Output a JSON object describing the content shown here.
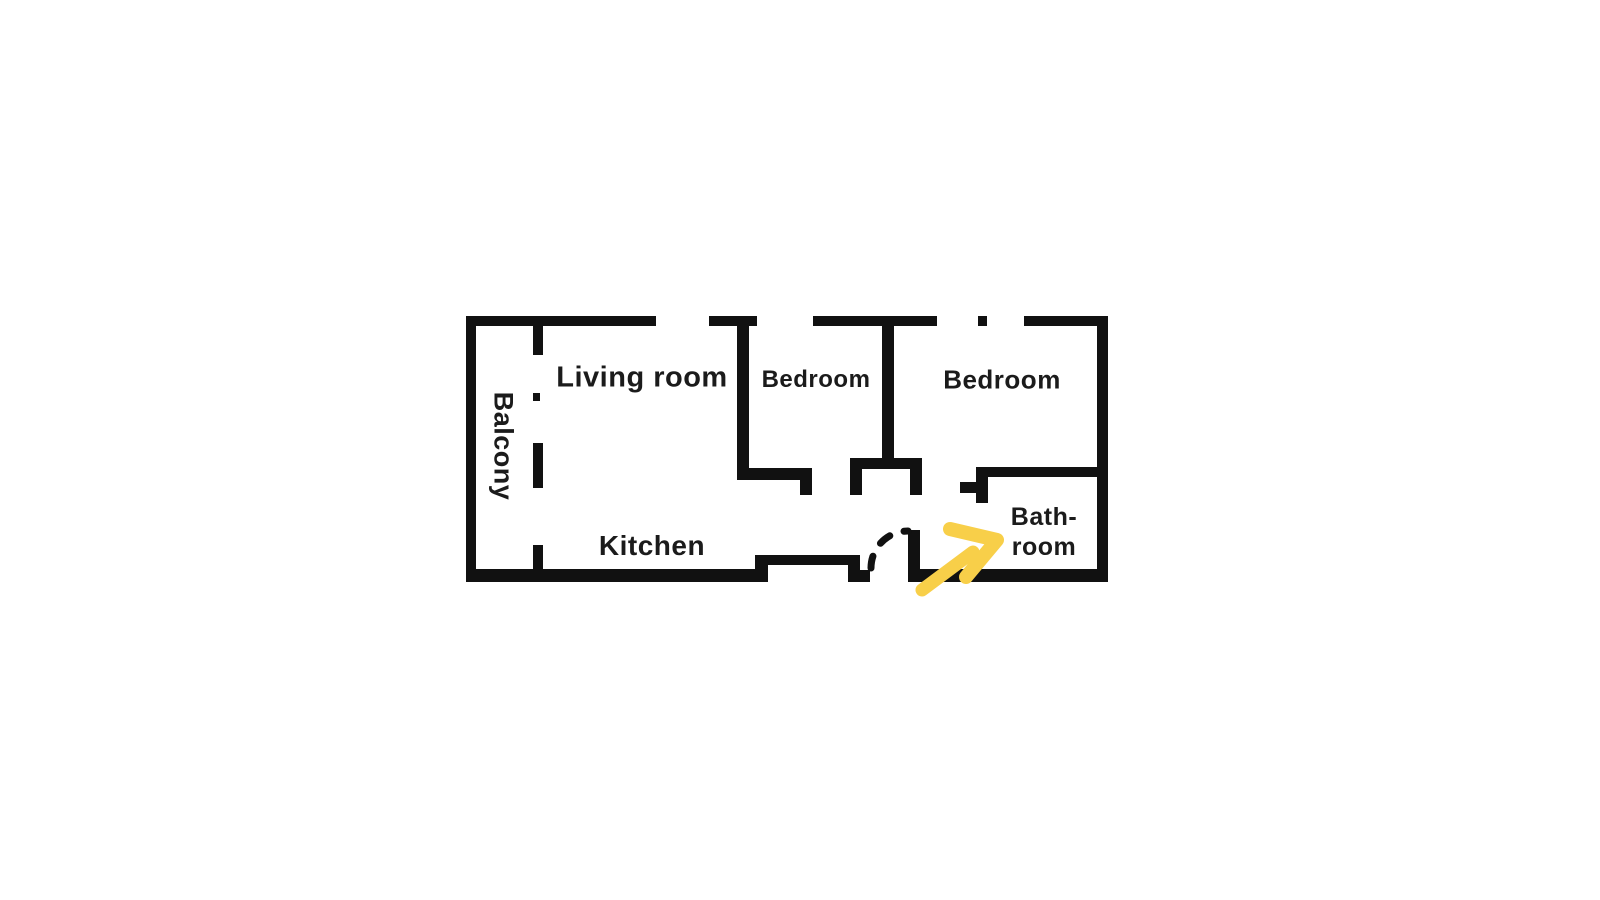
{
  "floor_plan": {
    "rooms": {
      "balcony": {
        "label": "Balcony"
      },
      "living_room": {
        "label": "Living room"
      },
      "bedroom_left": {
        "label": "Bedroom"
      },
      "bedroom_right": {
        "label": "Bedroom"
      },
      "kitchen": {
        "label": "Kitchen"
      },
      "bathroom": {
        "label_line_1": "Bath-",
        "label_line_2": "room"
      }
    },
    "colors": {
      "background": "#ffffff",
      "wall": "#111111",
      "label_text": "#1b1b1b",
      "annotation_arrow": "#f8cf49"
    },
    "annotation": {
      "icon": "arrow-up-right-icon",
      "points_to": "Bath-room"
    }
  }
}
